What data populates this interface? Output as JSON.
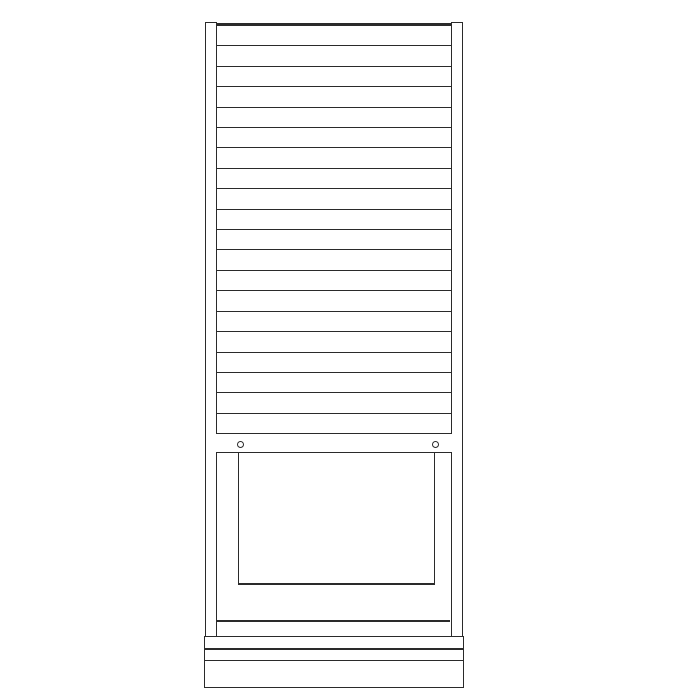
{
  "diagram": {
    "background_color": "#ffffff",
    "line_color": "#2a2a2a",
    "shutter": {
      "slat_count": 20
    },
    "rail": {
      "screw_count": 2
    },
    "plinth": {
      "band_count": 3
    }
  }
}
